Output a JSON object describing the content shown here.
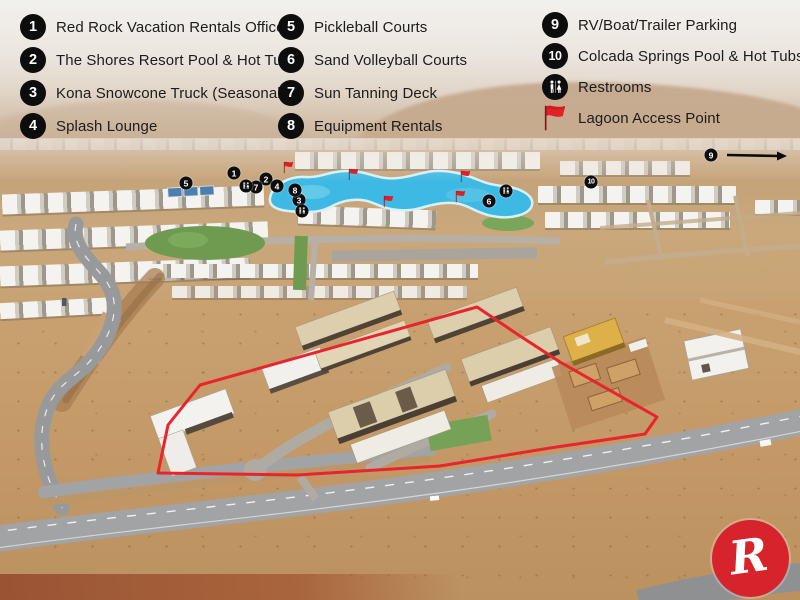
{
  "legend": {
    "columns": [
      {
        "items": [
          {
            "icon": "1",
            "label": "Red Rock Vacation Rentals Office"
          },
          {
            "icon": "2",
            "label": "The Shores Resort Pool & Hot Tub"
          },
          {
            "icon": "3",
            "label": "Kona Snowcone Truck (Seasonal)"
          },
          {
            "icon": "4",
            "label": "Splash Lounge"
          }
        ]
      },
      {
        "items": [
          {
            "icon": "5",
            "label": "Pickleball Courts"
          },
          {
            "icon": "6",
            "label": "Sand Volleyball Courts"
          },
          {
            "icon": "7",
            "label": "Sun Tanning Deck"
          },
          {
            "icon": "8",
            "label": "Equipment Rentals"
          }
        ]
      },
      {
        "items": [
          {
            "icon": "9",
            "label": "RV/Boat/Trailer Parking"
          },
          {
            "icon": "10",
            "label": "Colcada Springs Pool & Hot Tubs"
          },
          {
            "icon": "restrooms-icon",
            "label": "Restrooms"
          },
          {
            "icon": "flag-icon",
            "label": "Lagoon Access Point"
          }
        ]
      }
    ]
  },
  "map": {
    "markers": [
      {
        "icon": "1",
        "x": 234,
        "y": 173
      },
      {
        "icon": "2",
        "x": 266,
        "y": 179
      },
      {
        "icon": "3",
        "x": 299,
        "y": 200
      },
      {
        "icon": "4",
        "x": 277,
        "y": 186
      },
      {
        "icon": "5",
        "x": 186,
        "y": 183
      },
      {
        "icon": "6",
        "x": 489,
        "y": 201
      },
      {
        "icon": "7",
        "x": 256,
        "y": 187
      },
      {
        "icon": "8",
        "x": 295,
        "y": 190
      },
      {
        "icon": "9",
        "x": 711,
        "y": 155
      },
      {
        "icon": "10",
        "x": 591,
        "y": 182
      },
      {
        "icon": "restrooms-icon",
        "x": 246,
        "y": 186
      },
      {
        "icon": "restrooms-icon",
        "x": 302,
        "y": 211
      },
      {
        "icon": "restrooms-icon",
        "x": 506,
        "y": 191
      }
    ],
    "flags": [
      {
        "x": 285,
        "y": 173
      },
      {
        "x": 350,
        "y": 180
      },
      {
        "x": 385,
        "y": 207
      },
      {
        "x": 462,
        "y": 182
      },
      {
        "x": 457,
        "y": 202
      }
    ],
    "arrow": {
      "x1": 727,
      "y1": 155,
      "x2": 779,
      "y2": 156
    },
    "boundary_points": "200,385 477,307 517,334 560,362 657,417 645,434 550,448 440,466 297,475 158,473 168,425"
  },
  "logo": {
    "letter": "R"
  },
  "colors": {
    "accent_red": "#d7242c",
    "boundary_red": "#e8242c",
    "flag_red": "#e02127",
    "marker_black": "#0d0d0d",
    "lagoon_blue": "#3eb9e3"
  }
}
